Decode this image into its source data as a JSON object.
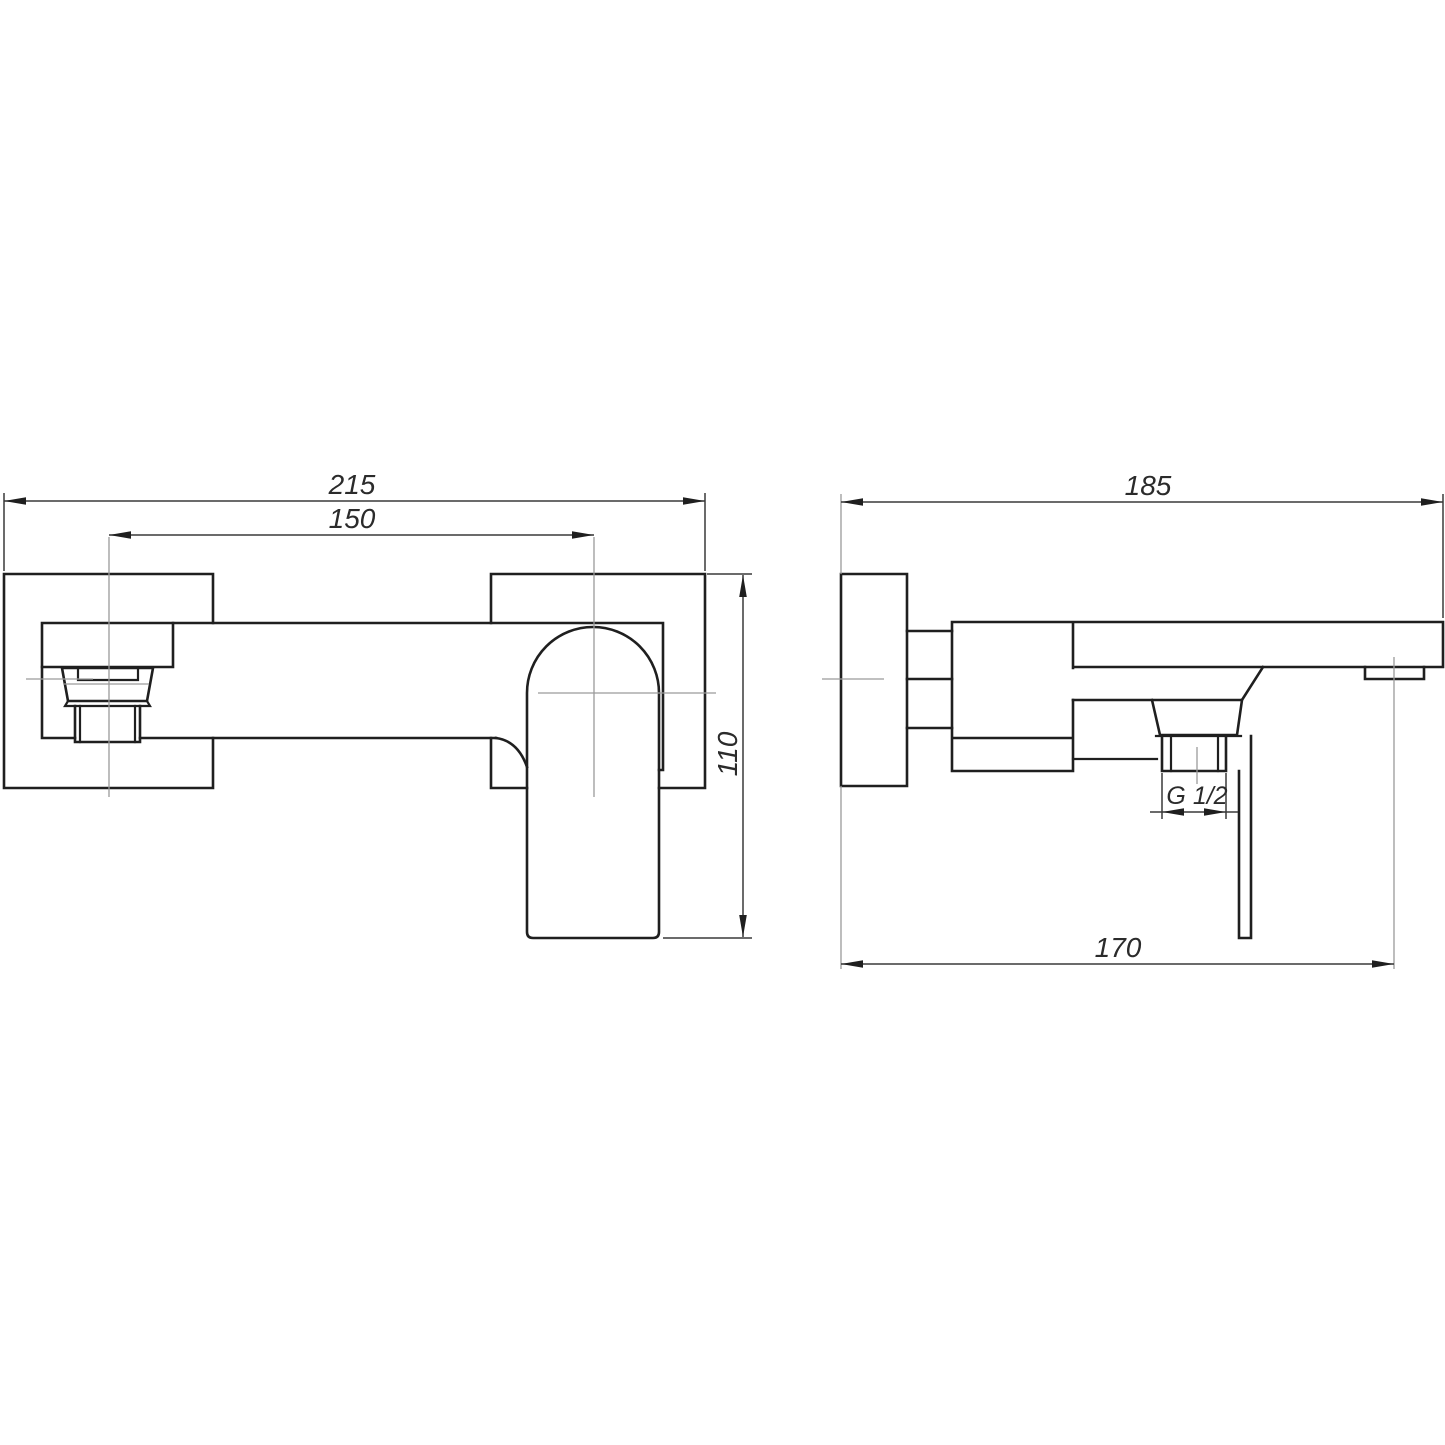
{
  "page": {
    "background": "#ffffff"
  },
  "drawing": {
    "line_color": "#1f1f1f",
    "centerline_color": "#9a9a9a",
    "views": {
      "front": {
        "dimensions": {
          "overall_width": "215",
          "spout_to_handle": "150",
          "height": "110"
        }
      },
      "side": {
        "dimensions": {
          "depth": "185",
          "outlet_thread": "G 1/2",
          "wall_to_outlet": "170"
        }
      }
    }
  }
}
